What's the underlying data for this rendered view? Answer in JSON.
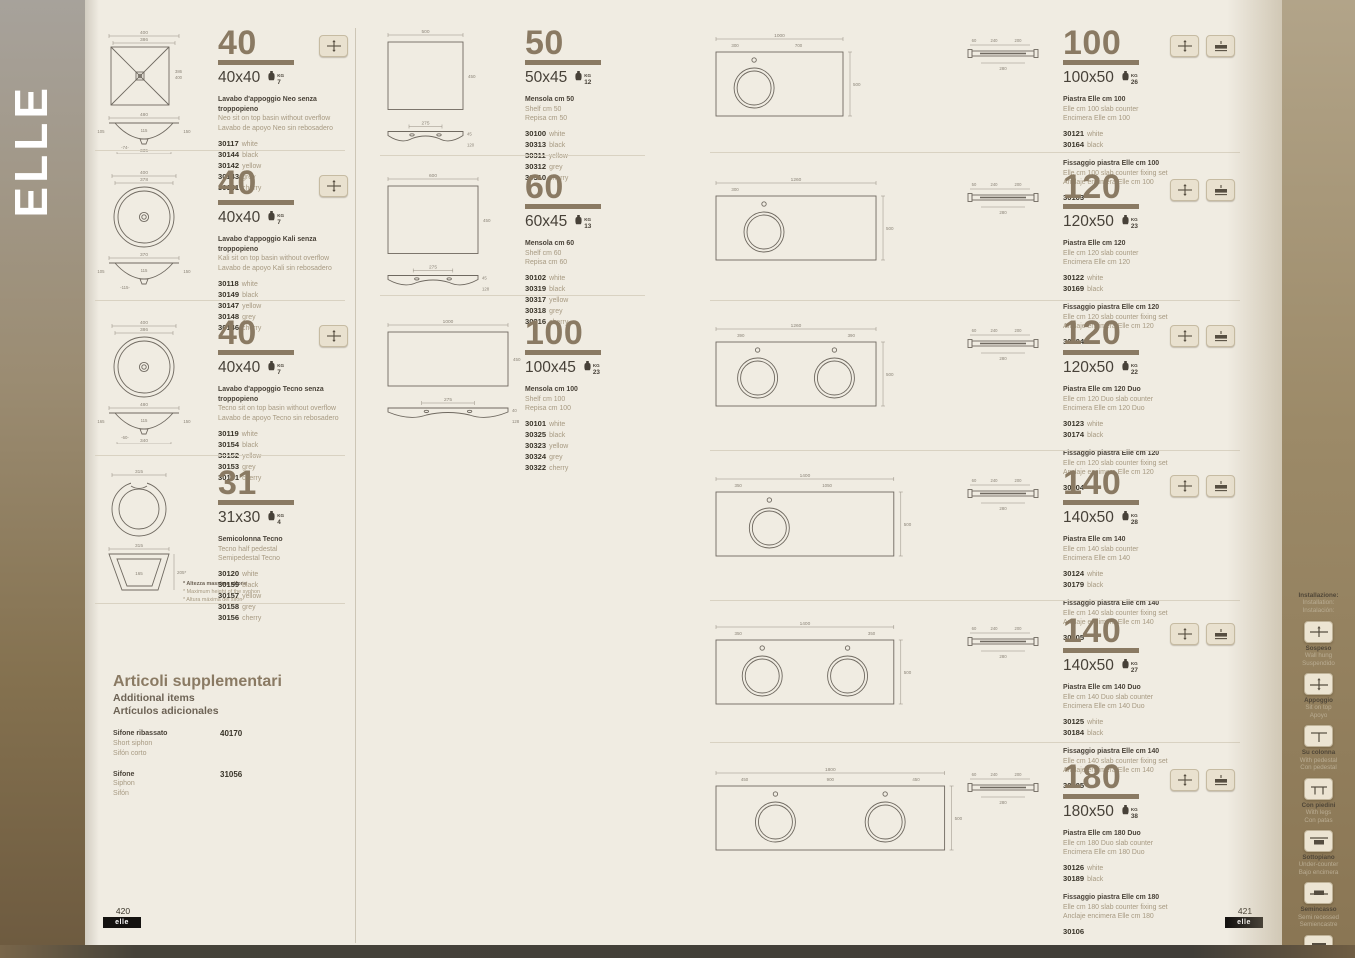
{
  "page": {
    "brand": "ELLE",
    "left_footer": {
      "page": "420",
      "label": "elle"
    },
    "right_footer": {
      "page": "421",
      "label": "elle"
    }
  },
  "supplementary": {
    "title": "Articoli supplementari",
    "subtitle_en": "Additional items",
    "subtitle_es": "Artículos adicionales",
    "items": [
      {
        "names": [
          "Sifone ribassato",
          "Short siphon",
          "Sifón corto"
        ],
        "code": "40170"
      },
      {
        "names": [
          "Sifone",
          "Siphon",
          "Sifón"
        ],
        "code": "31056"
      }
    ]
  },
  "sidebar": {
    "title": [
      "Installazione:",
      "Installation:",
      "Instalación:"
    ],
    "items": [
      {
        "icon": "wall-hung-icon",
        "labels": [
          "Sospeso",
          "Wall hung",
          "Suspendido"
        ]
      },
      {
        "icon": "sit-on-top-icon",
        "labels": [
          "Appoggio",
          "Sit on top",
          "Apoyo"
        ]
      },
      {
        "icon": "with-pedestal-icon",
        "labels": [
          "Su colonna",
          "With pedestal",
          "Con pedestal"
        ]
      },
      {
        "icon": "with-legs-icon",
        "labels": [
          "Con piedini",
          "With legs",
          "Con patas"
        ]
      },
      {
        "icon": "under-counter-icon",
        "labels": [
          "Sottopiano",
          "Under-counter",
          "Bajo encimera"
        ]
      },
      {
        "icon": "semi-recessed-icon",
        "labels": [
          "Semincasso",
          "Semi recessed",
          "Semiencastre"
        ]
      },
      {
        "icon": "cabinet-basin-icon",
        "labels": [
          "Su mobile",
          "Cabinet basin",
          "Con mueble"
        ]
      }
    ]
  },
  "weight_unit": "KG",
  "products": [
    {
      "size_big": "40",
      "size": "40x40",
      "weight_kg": "7",
      "icons": [
        "sit-on-top-icon"
      ],
      "names": [
        "Lavabo d'appoggio Neo senza troppopieno",
        "Neo sit on top basin without overflow",
        "Lavabo de apoyo Neo sin rebosadero"
      ],
      "codes": [
        {
          "code": "30117",
          "color": "white"
        },
        {
          "code": "30144",
          "color": "black"
        },
        {
          "code": "30142",
          "color": "yellow"
        },
        {
          "code": "30143",
          "color": "grey"
        },
        {
          "code": "30141",
          "color": "cherry"
        }
      ],
      "drawing": {
        "type": "basin-square",
        "top_dims": [
          "400",
          "386"
        ],
        "side_dims": [
          "386",
          "400"
        ],
        "profile": {
          "width": "480",
          "left": "105",
          "mid": "115",
          "right": "150",
          "bottom_offset": "74",
          "bottom": "335"
        }
      }
    },
    {
      "size_big": "40",
      "size": "40x40",
      "weight_kg": "7",
      "icons": [
        "sit-on-top-icon"
      ],
      "names": [
        "Lavabo d'appoggio Kali senza troppopieno",
        "Kali sit on top basin without overflow",
        "Lavabo de apoyo Kali sin rebosadero"
      ],
      "codes": [
        {
          "code": "30118",
          "color": "white"
        },
        {
          "code": "30149",
          "color": "black"
        },
        {
          "code": "30147",
          "color": "yellow"
        },
        {
          "code": "30148",
          "color": "grey"
        },
        {
          "code": "30146",
          "color": "cherry"
        }
      ],
      "drawing": {
        "type": "basin-round",
        "top_dims": [
          "400",
          "378"
        ],
        "profile": {
          "width": "370",
          "left": "105",
          "mid": "115",
          "right": "150",
          "bottom_offset": "115",
          "bottom": ""
        }
      }
    },
    {
      "size_big": "40",
      "size": "40x40",
      "weight_kg": "7",
      "icons": [
        "sit-on-top-icon"
      ],
      "names": [
        "Lavabo d'appoggio Tecno  senza troppopieno",
        "Tecno sit on top basin without overflow",
        "Lavabo de apoyo Tecno sin rebosadero"
      ],
      "codes": [
        {
          "code": "30119",
          "color": "white"
        },
        {
          "code": "30154",
          "color": "black"
        },
        {
          "code": "30152",
          "color": "yellow"
        },
        {
          "code": "30153",
          "color": "grey"
        },
        {
          "code": "30151",
          "color": "cherry"
        }
      ],
      "drawing": {
        "type": "basin-round",
        "top_dims": [
          "400",
          "386"
        ],
        "profile": {
          "width": "480",
          "left": "165",
          "mid": "115",
          "right": "150",
          "bottom_offset": "60",
          "bottom": "340"
        }
      }
    },
    {
      "size_big": "31",
      "size": "31x30",
      "weight_kg": "4",
      "icons": [],
      "names": [
        "Semicolonna Tecno",
        "Tecno half pedestal",
        "Semipedestal Tecno"
      ],
      "codes": [
        {
          "code": "30120",
          "color": "white"
        },
        {
          "code": "30159",
          "color": "black"
        },
        {
          "code": "30157",
          "color": "yellow"
        },
        {
          "code": "30158",
          "color": "grey"
        },
        {
          "code": "30156",
          "color": "cherry"
        }
      ],
      "drawing": {
        "type": "pedestal",
        "top_dim": "315",
        "front": {
          "top": "315",
          "inner": "165",
          "side": "205*"
        },
        "notes": [
          "* Altezza massima sifone",
          "* Maximum height of the syphon",
          "* Altura máxima del sifón"
        ]
      }
    },
    {
      "size_big": "50",
      "size": "50x45",
      "weight_kg": "12",
      "icons": [],
      "names": [
        "Mensola cm 50",
        "Shelf cm 50",
        "Repisa cm 50"
      ],
      "codes": [
        {
          "code": "30100",
          "color": "white"
        },
        {
          "code": "30313",
          "color": "black"
        },
        {
          "code": "30311",
          "color": "yellow"
        },
        {
          "code": "30312",
          "color": "grey"
        },
        {
          "code": "30310",
          "color": "cherry"
        }
      ],
      "drawing": {
        "type": "shelf",
        "rect": [
          "500",
          "450"
        ],
        "profile": [
          "275",
          "45",
          "120"
        ]
      }
    },
    {
      "size_big": "60",
      "size": "60x45",
      "weight_kg": "13",
      "icons": [],
      "names": [
        "Mensola cm 60",
        "Shelf cm 60",
        "Repisa cm 60"
      ],
      "codes": [
        {
          "code": "30102",
          "color": "white"
        },
        {
          "code": "30319",
          "color": "black"
        },
        {
          "code": "30317",
          "color": "yellow"
        },
        {
          "code": "30318",
          "color": "grey"
        },
        {
          "code": "30316",
          "color": "cherry"
        }
      ],
      "drawing": {
        "type": "shelf",
        "rect": [
          "600",
          "450"
        ],
        "profile": [
          "275",
          "45",
          "128"
        ]
      }
    },
    {
      "size_big": "100",
      "size": "100x45",
      "weight_kg": "23",
      "icons": [],
      "names": [
        "Mensola cm 100",
        "Shelf cm 100",
        "Repisa cm 100"
      ],
      "codes": [
        {
          "code": "30101",
          "color": "white"
        },
        {
          "code": "30325",
          "color": "black"
        },
        {
          "code": "30323",
          "color": "yellow"
        },
        {
          "code": "30324",
          "color": "grey"
        },
        {
          "code": "30322",
          "color": "cherry"
        }
      ],
      "drawing": {
        "type": "shelf",
        "rect": [
          "1000",
          "450"
        ],
        "profile": [
          "275",
          "40",
          "128"
        ]
      }
    },
    {
      "size_big": "100",
      "size": "100x50",
      "weight_kg": "26",
      "icons": [
        "sit-on-top-icon",
        "slab-counter-icon"
      ],
      "names": [
        "Piastra Elle cm 100",
        "Elle cm 100 slab counter",
        "Encimera Elle cm 100"
      ],
      "codes": [
        {
          "code": "30121",
          "color": "white"
        },
        {
          "code": "30164",
          "color": "black"
        }
      ],
      "fixing": {
        "names": [
          "Fissaggio piastra Elle cm 100",
          "Elle cm 100 slab counter fixing set",
          "Anclaje encimera Elle cm 100"
        ],
        "code": "30103"
      },
      "drawing": {
        "type": "plate",
        "total": "1000",
        "segs": [
          "300",
          "700"
        ],
        "height": "500",
        "holes": 1,
        "section": [
          "60",
          "240",
          "200",
          "280"
        ]
      }
    },
    {
      "size_big": "120",
      "size": "120x50",
      "weight_kg": "23",
      "icons": [
        "sit-on-top-icon",
        "slab-counter-icon"
      ],
      "names": [
        "Piastra Elle cm 120",
        "Elle cm 120 slab counter",
        "Encimera Elle cm 120"
      ],
      "codes": [
        {
          "code": "30122",
          "color": "white"
        },
        {
          "code": "30169",
          "color": "black"
        }
      ],
      "fixing": {
        "names": [
          "Fissaggio piastra Elle cm 120",
          "Elle cm 120 slab counter fixing set",
          "Anclaje encimera Elle cm 120"
        ],
        "code": "30104"
      },
      "drawing": {
        "type": "plate",
        "total": "1260",
        "segs": [
          "300"
        ],
        "height": "500",
        "holes": 1,
        "section": [
          "50",
          "240",
          "200",
          "280"
        ]
      }
    },
    {
      "size_big": "120",
      "size": "120x50",
      "weight_kg": "22",
      "icons": [
        "sit-on-top-icon",
        "slab-counter-icon"
      ],
      "names": [
        "Piastra Elle cm 120 Duo",
        "Elle cm 120 Duo slab counter",
        "Encimera Elle cm 120 Duo"
      ],
      "codes": [
        {
          "code": "30123",
          "color": "white"
        },
        {
          "code": "30174",
          "color": "black"
        }
      ],
      "fixing": {
        "names": [
          "Fissaggio piastra Elle cm 120",
          "Elle cm 120 slab counter fixing set",
          "Anclaje encimera Elle cm 120"
        ],
        "code": "30104"
      },
      "drawing": {
        "type": "plate",
        "total": "1260",
        "segs": [
          "390",
          "390"
        ],
        "height": "500",
        "holes": 2,
        "section": [
          "60",
          "240",
          "200",
          "280"
        ]
      }
    },
    {
      "size_big": "140",
      "size": "140x50",
      "weight_kg": "28",
      "icons": [
        "sit-on-top-icon",
        "slab-counter-icon"
      ],
      "names": [
        "Piastra Elle cm 140",
        "Elle cm 140 slab counter",
        "Encimera Elle cm 140"
      ],
      "codes": [
        {
          "code": "30124",
          "color": "white"
        },
        {
          "code": "30179",
          "color": "black"
        }
      ],
      "fixing": {
        "names": [
          "Fissaggio piastra Elle cm 140",
          "Elle cm 140 slab counter fixing set",
          "Anclaje encimera Elle cm 140"
        ],
        "code": "30105"
      },
      "drawing": {
        "type": "plate",
        "total": "1400",
        "segs": [
          "350",
          "1050"
        ],
        "height": "500",
        "holes": 1,
        "section": [
          "60",
          "240",
          "200",
          "280"
        ]
      }
    },
    {
      "size_big": "140",
      "size": "140x50",
      "weight_kg": "27",
      "icons": [
        "sit-on-top-icon",
        "slab-counter-icon"
      ],
      "names": [
        "Piastra Elle cm 140 Duo",
        "Elle cm 140 Duo slab counter",
        "Encimera Elle cm 140 Duo"
      ],
      "codes": [
        {
          "code": "30125",
          "color": "white"
        },
        {
          "code": "30184",
          "color": "black"
        }
      ],
      "fixing": {
        "names": [
          "Fissaggio piastra Elle cm 140",
          "Elle cm 140 slab counter fixing set",
          "Anclaje encimera Elle cm 140"
        ],
        "code": "30105"
      },
      "drawing": {
        "type": "plate",
        "total": "1400",
        "segs": [
          "350",
          "350"
        ],
        "height": "500",
        "holes": 2,
        "section": [
          "60",
          "240",
          "200",
          "280"
        ]
      }
    },
    {
      "size_big": "180",
      "size": "180x50",
      "weight_kg": "38",
      "icons": [
        "sit-on-top-icon",
        "slab-counter-icon"
      ],
      "names": [
        "Piastra Elle cm 180 Duo",
        "Elle cm 180 Duo slab counter",
        "Encimera Elle cm 180 Duo"
      ],
      "codes": [
        {
          "code": "30126",
          "color": "white"
        },
        {
          "code": "30189",
          "color": "black"
        }
      ],
      "fixing": {
        "names": [
          "Fissaggio piastra Elle cm 180",
          "Elle cm 180 slab counter fixing set",
          "Anclaje encimera Elle cm 180"
        ],
        "code": "30106"
      },
      "drawing": {
        "type": "plate",
        "total": "1800",
        "segs": [
          "450",
          "900",
          "450"
        ],
        "height": "500",
        "holes": 2,
        "section": [
          "60",
          "240",
          "200",
          "280"
        ]
      }
    }
  ]
}
